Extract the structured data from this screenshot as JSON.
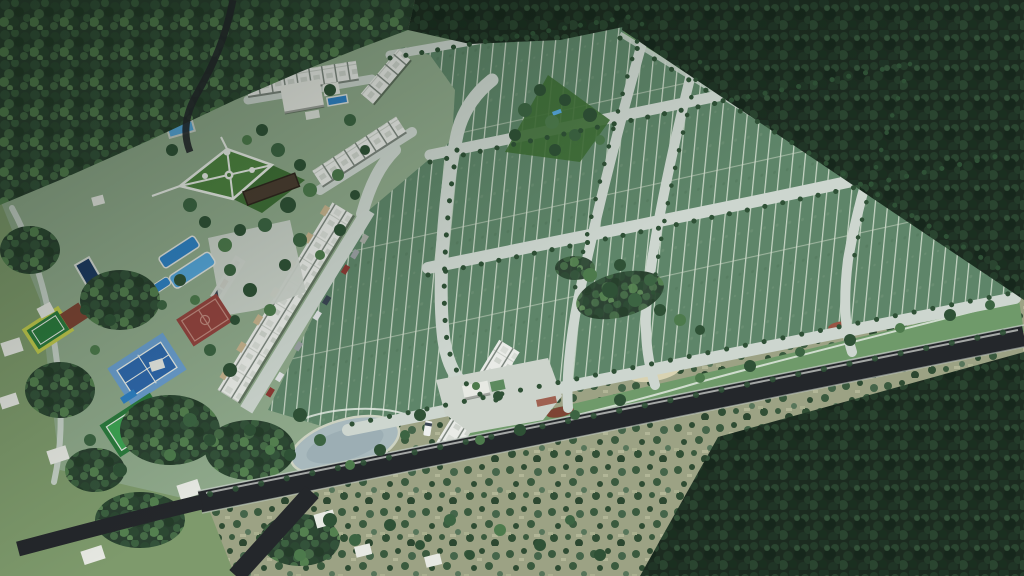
{
  "scene": {
    "description": "Aerial 3D render of a gated residential land development carved out of dense jungle: a grid of green residential lots with tree-lined streets, townhouse rows, a clubhouse with pools, a water park, a formal garden, tennis, basketball and multisport courts, a linear park, a pond, and an entrance gatehouse on a dark perimeter road, surrounded by forest and scrubland with neighboring houses to the southwest.",
    "elements": [
      "surrounding-jungle",
      "residential-lot-grid",
      "internal-streets",
      "perimeter-road",
      "entrance-gatehouse",
      "entrance-plaza",
      "shuttle-vehicle",
      "townhouse-rows",
      "parked-cars",
      "clubhouse",
      "swimming-pools",
      "water-park",
      "formal-garden",
      "pergola",
      "basketball-court",
      "tennis-court",
      "multisport-court",
      "practice-court",
      "lap-pool",
      "linear-park",
      "pocket-park",
      "pond",
      "neighboring-houses",
      "scrubland",
      "street-trees"
    ],
    "colors": {
      "base_scrub": "#9ca284",
      "grass_sw": "#7e9a6c",
      "grass_dev": "#8fa98b",
      "forest_base_a": "#1c2b20",
      "forest_base_b": "#2a4030",
      "lot_green": "#5e8569",
      "lot_line": "#d9e2d4",
      "street": "#cdd6cf",
      "road_asphalt": "#24272b",
      "road_edge": "#c6cec7",
      "park_green": "#6f9a6a",
      "garden_green": "#4e8340",
      "garden_green2": "#3f6f36",
      "path_white": "#e9ede7",
      "roof_white": "#e9ebe7",
      "canopy_beige": "#c6b28d",
      "pool_blue": "#2f82c6",
      "pool_light": "#56a7dc",
      "pool_dark": "#1d3a62",
      "court_red": "#94443f",
      "court_red_line": "#c08a7f",
      "tennis_out": "#6b9fd0",
      "tennis_in": "#2f69ae",
      "court_green": "#3da553",
      "court_green_dark": "#2c7c3e",
      "court_yellow": "#c3cc4e",
      "patch_rust": "#7e4434",
      "plaza": "#ccd3cb",
      "sand": "#d9d3b2",
      "pond_gray": "#a8b9bd",
      "flower_red": "#9a5444",
      "tree_dark": "#2f5136",
      "tree_light": "#4d7a4c",
      "tree_mid": "#3c6442",
      "house_white": "#e7e9e3",
      "house_shadow": "#a9aea6",
      "car_red": "#8c3a34",
      "car_gray": "#9aa0a3",
      "car_white": "#e2e5e6",
      "car_dark": "#3a4553"
    }
  }
}
